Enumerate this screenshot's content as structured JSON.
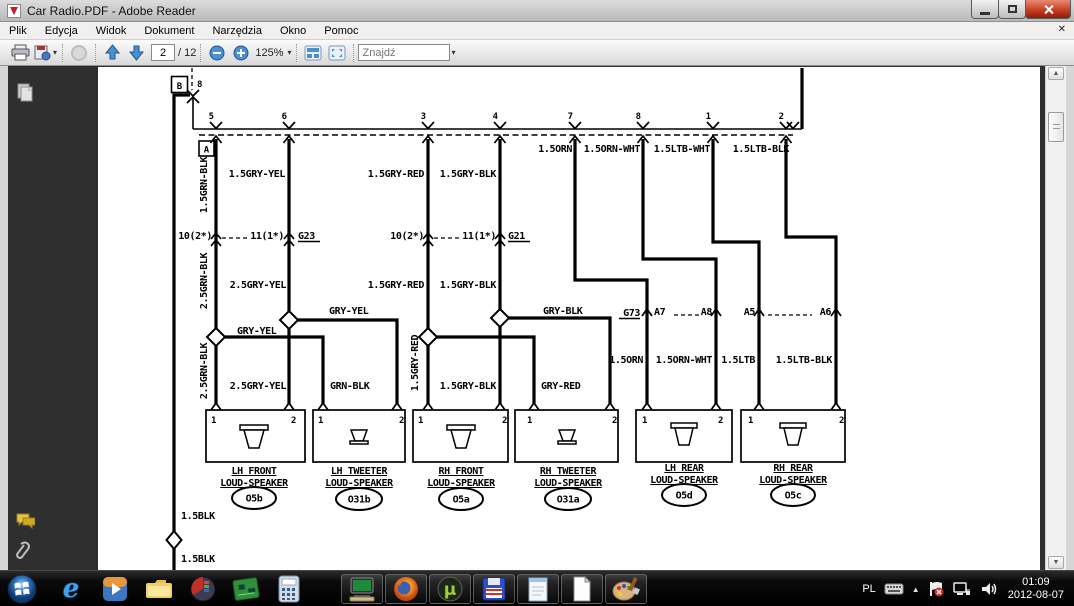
{
  "window": {
    "title": "Car Radio.PDF - Adobe Reader"
  },
  "menu": {
    "items": [
      "Plik",
      "Edycja",
      "Widok",
      "Dokument",
      "Narzędzia",
      "Okno",
      "Pomoc"
    ]
  },
  "toolbar": {
    "page_current": "2",
    "page_total": "/ 12",
    "zoom_level": "125%",
    "search_placeholder": "Znajdź"
  },
  "glyphs": {
    "caret": "▾",
    "menubar_close": "✕",
    "tray_expand": "▲",
    "scroll_up": "▲",
    "scroll_down": "▼",
    "ie": "e",
    "utorrent": "µ",
    "play": "▶"
  },
  "diagram": {
    "top_connector": {
      "box": "B",
      "pin": "8"
    },
    "bus_connector": {
      "box": "A"
    },
    "bus_pins": [
      "5",
      "6",
      "3",
      "4",
      "7",
      "8",
      "1",
      "2"
    ],
    "labels": {
      "w1_top": "1.5GRN-BLK",
      "w1_conn": "10(2*)",
      "w1_mid": "2.5GRN-BLK",
      "w1_low": "2.5GRN-BLK",
      "w1_branch": "GRY-YEL",
      "w1_branch_drop": "GRN-BLK",
      "w2_top": "1.5GRY-YEL",
      "w2_conn": "11(1*)",
      "w2_ground": "G23",
      "w2_mid": "2.5GRY-YEL",
      "w2_branch": "GRY-YEL",
      "w2_low": "2.5GRY-YEL",
      "w3_top": "1.5GRY-RED",
      "w3_conn": "10(2*)",
      "w3_mid": "1.5GRY-RED",
      "w3_rot": "1.5GRY-RED",
      "w3_branch_drop": "GRY-RED",
      "w4_top": "1.5GRY-BLK",
      "w4_conn": "11(1*)",
      "w4_ground": "G21",
      "w4_mid": "1.5GRY-BLK",
      "w4_branch": "GRY-BLK",
      "w4_low": "1.5GRY-BLK",
      "w5_top": "1.5ORN",
      "w5_ground": "G73",
      "w5_pin": "A7",
      "w5_low": "1.5ORN",
      "w6_top": "1.5ORN-WHT",
      "w6_pin": "A8",
      "w6_low": "1.5ORN-WHT",
      "w7_top": "1.5LTB-WHT",
      "w7_pin": "A5",
      "w7_low": "1.5LTB",
      "w8_top": "1.5LTB-BLK",
      "w8_pin": "A6",
      "w8_low": "1.5LTB-BLK",
      "main_1": "1.5BLK",
      "main_2": "1.5BLK"
    },
    "speakers": [
      {
        "pin1": "1",
        "pin2": "2",
        "name1": "LH FRONT",
        "name2": "LOUD-SPEAKER",
        "code": "O5b"
      },
      {
        "pin1": "1",
        "pin2": "2",
        "name1": "LH TWEETER",
        "name2": "LOUD-SPEAKER",
        "code": "O31b"
      },
      {
        "pin1": "1",
        "pin2": "2",
        "name1": "RH FRONT",
        "name2": "LOUD-SPEAKER",
        "code": "O5a"
      },
      {
        "pin1": "1",
        "pin2": "2",
        "name1": "RH TWEETER",
        "name2": "LOUD-SPEAKER",
        "code": "O31a"
      },
      {
        "pin1": "1",
        "pin2": "2",
        "name1": "LH REAR",
        "name2": "LOUD-SPEAKER",
        "code": "O5d"
      },
      {
        "pin1": "1",
        "pin2": "2",
        "name1": "RH REAR",
        "name2": "LOUD-SPEAKER",
        "code": "O5c"
      }
    ]
  },
  "tray": {
    "lang": "PL",
    "time": "01:09",
    "date": "2012-08-07"
  },
  "colors": {
    "accent_blue": "#3f7fce",
    "close_red": "#c23b1e",
    "canvas_dark": "#2f2f2f",
    "taskbar_bg": "#0a0a0a"
  }
}
